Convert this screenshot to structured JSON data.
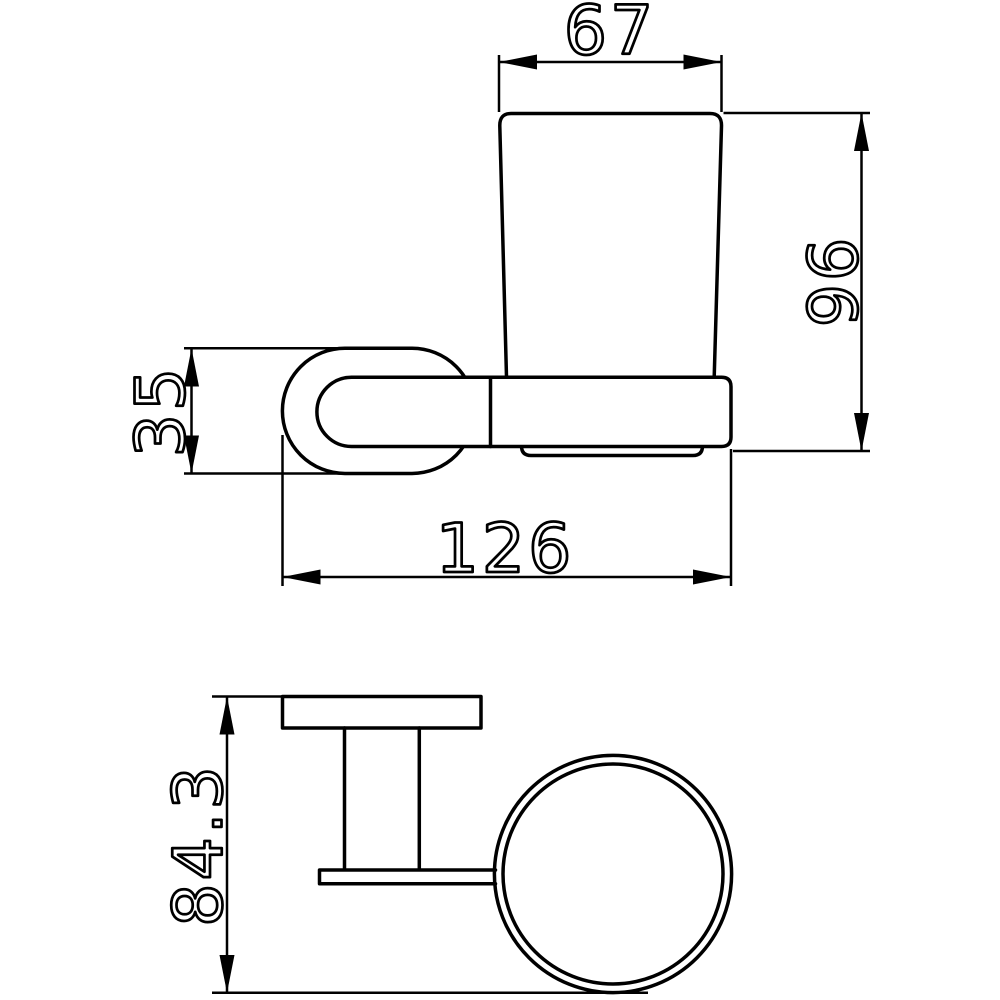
{
  "dimensions": {
    "cup_top_width": "67",
    "overall_height": "96",
    "bracket_height": "35",
    "overall_depth": "126",
    "top_view_depth": "84.3"
  },
  "colors": {
    "line": "#000000",
    "background": "#ffffff"
  }
}
